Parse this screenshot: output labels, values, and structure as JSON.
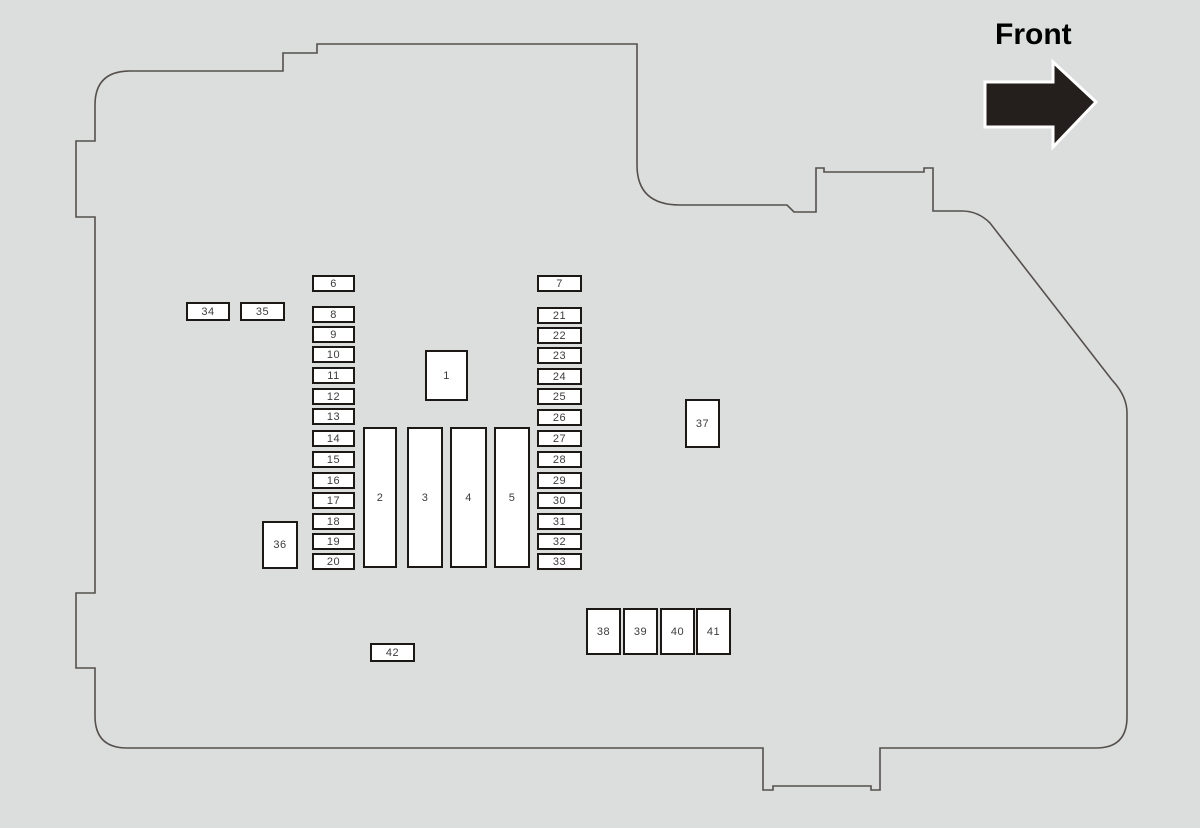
{
  "front": {
    "label": "Front"
  },
  "colors": {
    "background": "#dcdedd",
    "outline": "#55504d",
    "fuse_border": "#1c1816",
    "fuse_fill": "#ffffff",
    "label_text": "#3c3c3c",
    "arrow_fill": "#241f1c",
    "arrow_outline": "#ffffff"
  },
  "fuse_boxes": [
    {
      "label": "1",
      "x": 425,
      "y": 350,
      "w": 43,
      "h": 51
    },
    {
      "label": "2",
      "x": 363,
      "y": 427,
      "w": 34,
      "h": 141
    },
    {
      "label": "3",
      "x": 407,
      "y": 427,
      "w": 36,
      "h": 141
    },
    {
      "label": "4",
      "x": 450,
      "y": 427,
      "w": 37,
      "h": 141
    },
    {
      "label": "5",
      "x": 494,
      "y": 427,
      "w": 36,
      "h": 141
    },
    {
      "label": "6",
      "x": 312,
      "y": 275,
      "w": 43,
      "h": 17
    },
    {
      "label": "7",
      "x": 537,
      "y": 275,
      "w": 45,
      "h": 17
    },
    {
      "label": "8",
      "x": 312,
      "y": 306,
      "w": 43,
      "h": 17
    },
    {
      "label": "9",
      "x": 312,
      "y": 326,
      "w": 43,
      "h": 17
    },
    {
      "label": "10",
      "x": 312,
      "y": 346,
      "w": 43,
      "h": 17
    },
    {
      "label": "11",
      "x": 312,
      "y": 367,
      "w": 43,
      "h": 17
    },
    {
      "label": "12",
      "x": 312,
      "y": 388,
      "w": 43,
      "h": 17
    },
    {
      "label": "13",
      "x": 312,
      "y": 408,
      "w": 43,
      "h": 17
    },
    {
      "label": "14",
      "x": 312,
      "y": 430,
      "w": 43,
      "h": 17
    },
    {
      "label": "15",
      "x": 312,
      "y": 451,
      "w": 43,
      "h": 17
    },
    {
      "label": "16",
      "x": 312,
      "y": 472,
      "w": 43,
      "h": 17
    },
    {
      "label": "17",
      "x": 312,
      "y": 492,
      "w": 43,
      "h": 17
    },
    {
      "label": "18",
      "x": 312,
      "y": 513,
      "w": 43,
      "h": 17
    },
    {
      "label": "19",
      "x": 312,
      "y": 533,
      "w": 43,
      "h": 17
    },
    {
      "label": "20",
      "x": 312,
      "y": 553,
      "w": 43,
      "h": 17
    },
    {
      "label": "21",
      "x": 537,
      "y": 307,
      "w": 45,
      "h": 17
    },
    {
      "label": "22",
      "x": 537,
      "y": 327,
      "w": 45,
      "h": 17
    },
    {
      "label": "23",
      "x": 537,
      "y": 347,
      "w": 45,
      "h": 17
    },
    {
      "label": "24",
      "x": 537,
      "y": 368,
      "w": 45,
      "h": 17
    },
    {
      "label": "25",
      "x": 537,
      "y": 388,
      "w": 45,
      "h": 17
    },
    {
      "label": "26",
      "x": 537,
      "y": 409,
      "w": 45,
      "h": 17
    },
    {
      "label": "27",
      "x": 537,
      "y": 430,
      "w": 45,
      "h": 17
    },
    {
      "label": "28",
      "x": 537,
      "y": 451,
      "w": 45,
      "h": 17
    },
    {
      "label": "29",
      "x": 537,
      "y": 472,
      "w": 45,
      "h": 17
    },
    {
      "label": "30",
      "x": 537,
      "y": 492,
      "w": 45,
      "h": 17
    },
    {
      "label": "31",
      "x": 537,
      "y": 513,
      "w": 45,
      "h": 17
    },
    {
      "label": "32",
      "x": 537,
      "y": 533,
      "w": 45,
      "h": 17
    },
    {
      "label": "33",
      "x": 537,
      "y": 553,
      "w": 45,
      "h": 17
    },
    {
      "label": "34",
      "x": 186,
      "y": 302,
      "w": 44,
      "h": 19
    },
    {
      "label": "35",
      "x": 240,
      "y": 302,
      "w": 45,
      "h": 19
    },
    {
      "label": "36",
      "x": 262,
      "y": 521,
      "w": 36,
      "h": 48
    },
    {
      "label": "37",
      "x": 685,
      "y": 399,
      "w": 35,
      "h": 49
    },
    {
      "label": "38",
      "x": 586,
      "y": 608,
      "w": 35,
      "h": 47
    },
    {
      "label": "39",
      "x": 623,
      "y": 608,
      "w": 35,
      "h": 47
    },
    {
      "label": "40",
      "x": 660,
      "y": 608,
      "w": 35,
      "h": 47
    },
    {
      "label": "41",
      "x": 696,
      "y": 608,
      "w": 35,
      "h": 47
    },
    {
      "label": "42",
      "x": 370,
      "y": 643,
      "w": 45,
      "h": 19
    }
  ]
}
